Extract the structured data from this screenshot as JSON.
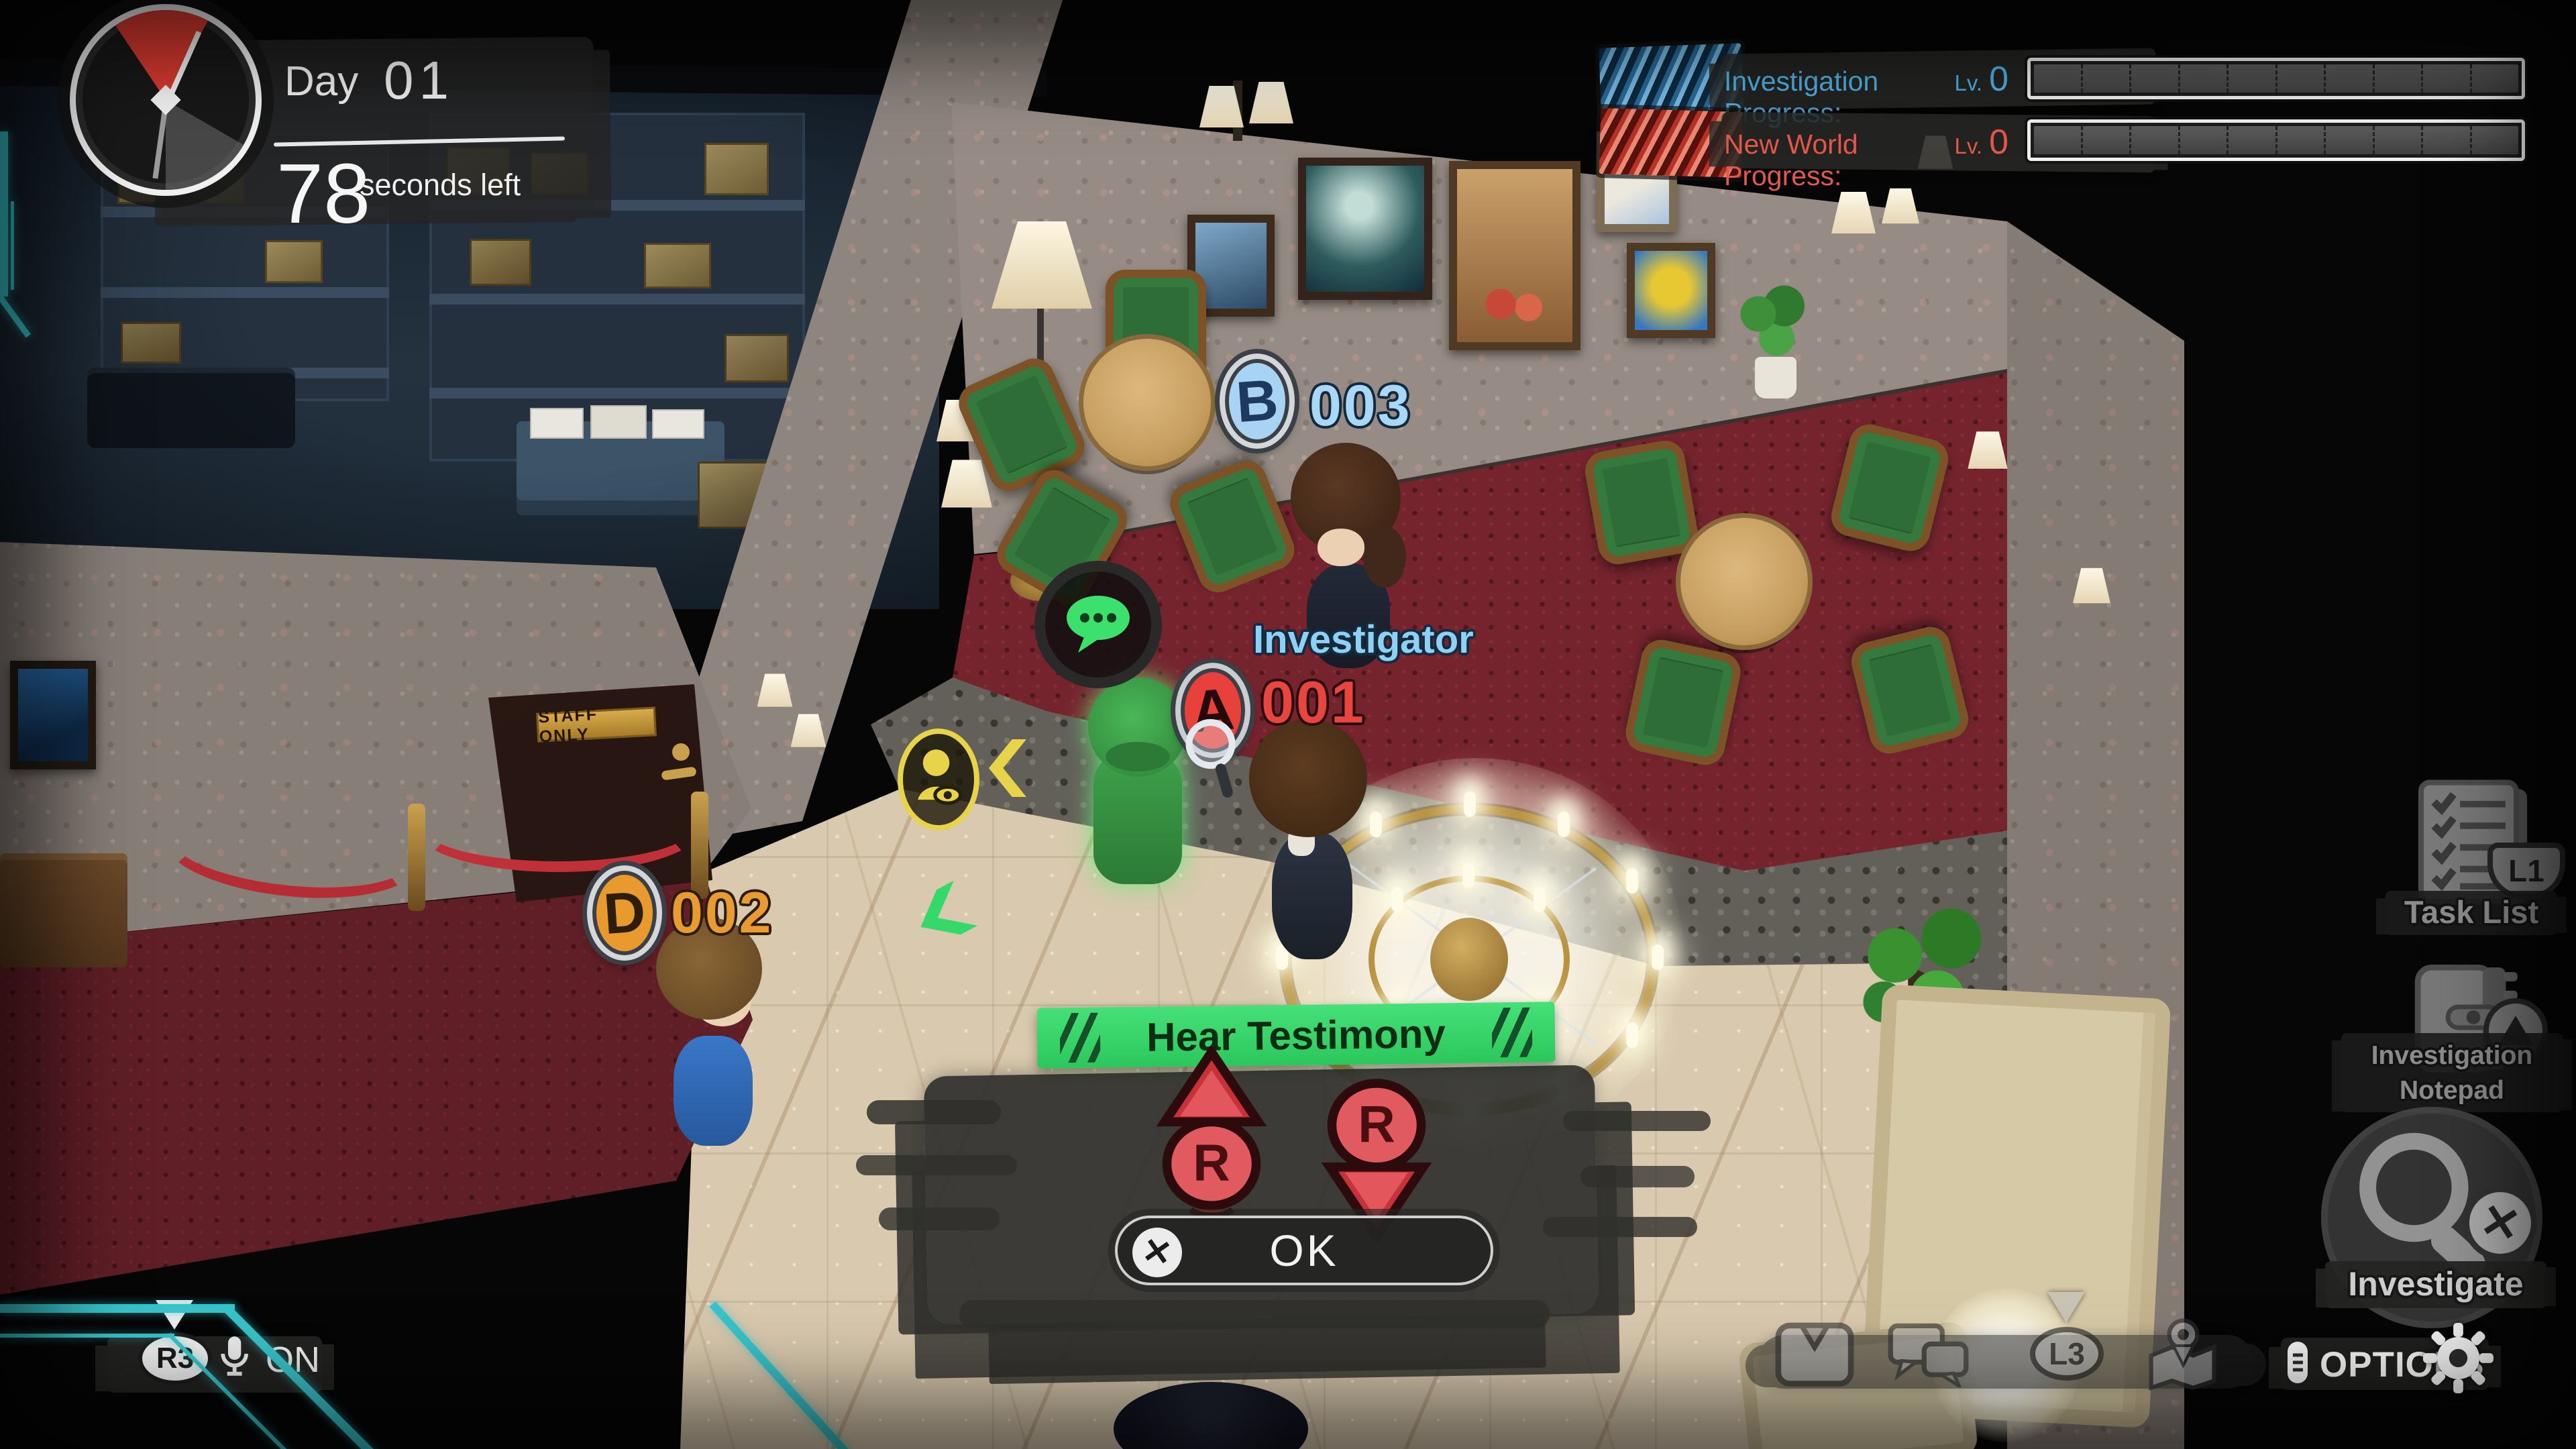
{
  "hud": {
    "timer": {
      "day_label": "Day",
      "day_value": "01",
      "seconds_value": "78",
      "seconds_label": "seconds left"
    },
    "progress": {
      "investigation": {
        "label": "Investigation Progress:",
        "level_prefix": "Lv.",
        "level": "0"
      },
      "new_world": {
        "label": "New World Progress:",
        "level_prefix": "Lv.",
        "level": "0"
      }
    },
    "voice_chat": {
      "stick_button": "R3",
      "state": "ON"
    },
    "right_menu": {
      "task_list": {
        "label": "Task List",
        "shortcut": "L1"
      },
      "notepad": {
        "label_line1": "Investigation",
        "label_line2": "Notepad"
      },
      "investigate": {
        "label": "Investigate"
      }
    },
    "toolbar": {
      "l3_label": "L3"
    },
    "options_label": "OPTIONS"
  },
  "action_prompt": {
    "title": "Hear Testimony",
    "r_button_label": "R",
    "confirm_label": "OK"
  },
  "characters": {
    "b": {
      "badge": "B",
      "number": "003"
    },
    "a": {
      "badge": "A",
      "number": "001",
      "title": "Investigator"
    },
    "d": {
      "badge": "D",
      "number": "002"
    }
  },
  "scene": {
    "door_plaque": "STAFF ONLY"
  },
  "colors": {
    "accent_cyan": "#37c4ca",
    "investigation_blue": "#4fb0e6",
    "new_world_red": "#e2584a",
    "banner_green": "#3cd96b",
    "button_red": "#d93a41",
    "badge_blue": "#a9d3f2",
    "badge_red": "#e8413c",
    "badge_orange": "#e89a2f",
    "label_blue": "#8ed1f5"
  }
}
